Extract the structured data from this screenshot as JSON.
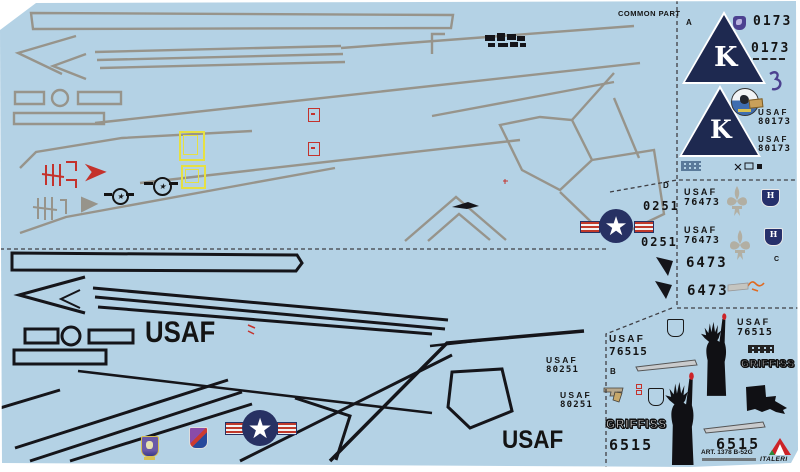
{
  "sheet": {
    "common_part": "COMMON PART",
    "art_number": "ART. 1378 B-52G",
    "brand": "ITALERI"
  },
  "sections": {
    "a": "A",
    "b": "B",
    "c": "C",
    "d": "D"
  },
  "labels": {
    "usaf": "USAF",
    "us_air_force": "U.S. AIR FORCE",
    "griffiss": "GRIFFISS",
    "k": "K",
    "h": "H"
  },
  "serials": {
    "s0173": "0173",
    "s80173": "80173",
    "s0251": "0251",
    "s76473": "76473",
    "s6473": "6473",
    "s76515": "76515",
    "s80251": "80251",
    "s6515": "6515"
  },
  "icons": {
    "star": "★",
    "heart": "♥"
  },
  "colors": {
    "sheet_blue": "#b4d2e5",
    "insignia_navy": "#273163",
    "decal_red": "#c4322c",
    "decal_yellow": "#e6e043",
    "walkway_gray": "#97948b",
    "emblem_purple": "#4c4190",
    "blade_silver": "#c9cbcd",
    "decal_black": "#141414"
  }
}
